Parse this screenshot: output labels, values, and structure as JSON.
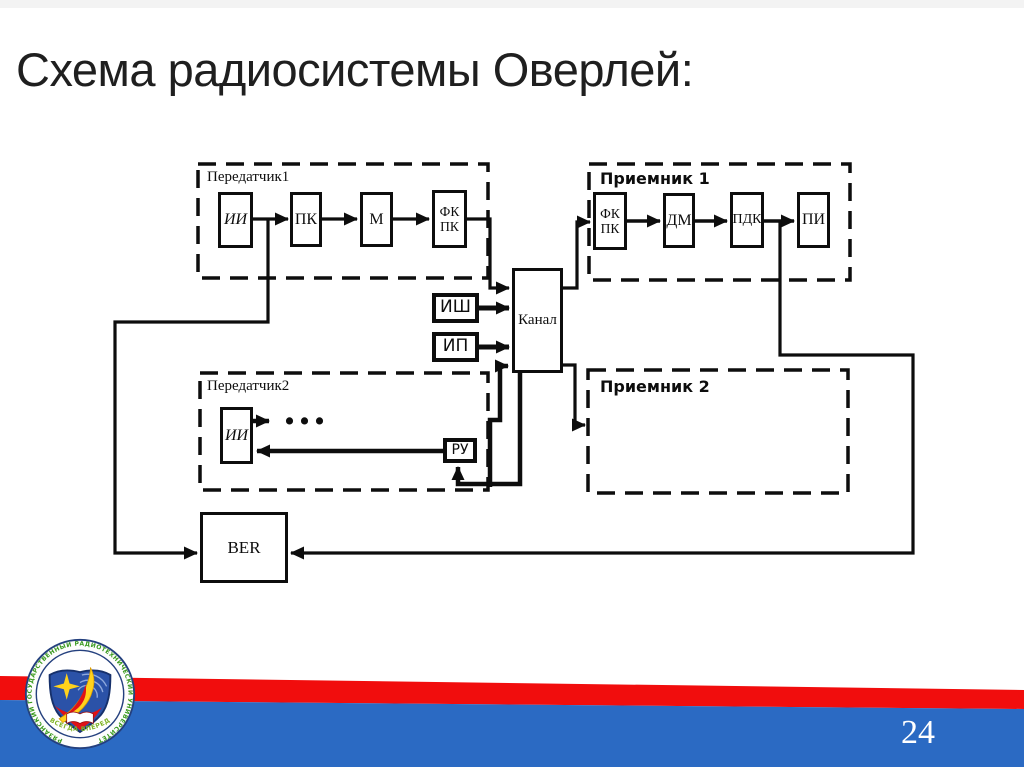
{
  "slide": {
    "title": "Схема радиосистемы Оверлей:",
    "page_number": "24"
  },
  "diagram": {
    "groups": {
      "tx1": "Передатчик1",
      "rx1": "Приемник 1",
      "tx2": "Передатчик2",
      "rx2": "Приемник 2"
    },
    "blocks": {
      "tx1_ii": "ИИ",
      "tx1_pk": "ПК",
      "tx1_m": "М",
      "fkpk_l1": "ФК",
      "fkpk_l2": "ПК",
      "rx1_dm": "ДМ",
      "rx1_pdk": "ПДК",
      "rx1_pi": "ПИ",
      "noise": "ИШ",
      "interference": "ИП",
      "channel": "Канал",
      "tx2_ii": "ИИ",
      "ru": "РУ",
      "ber": "BER",
      "ellipsis": "..."
    }
  },
  "footer": {
    "logo_ring_text": "РЯЗАНСКИЙ ГОСУДАРСТВЕННЫЙ РАДИОТЕХНИЧЕСКИЙ УНИВЕРСИТЕТ",
    "logo_motto": "ВСЕГДА ВПЕРЕД",
    "colors": {
      "red": "#f10d0d",
      "blue": "#2b6ac3"
    }
  }
}
